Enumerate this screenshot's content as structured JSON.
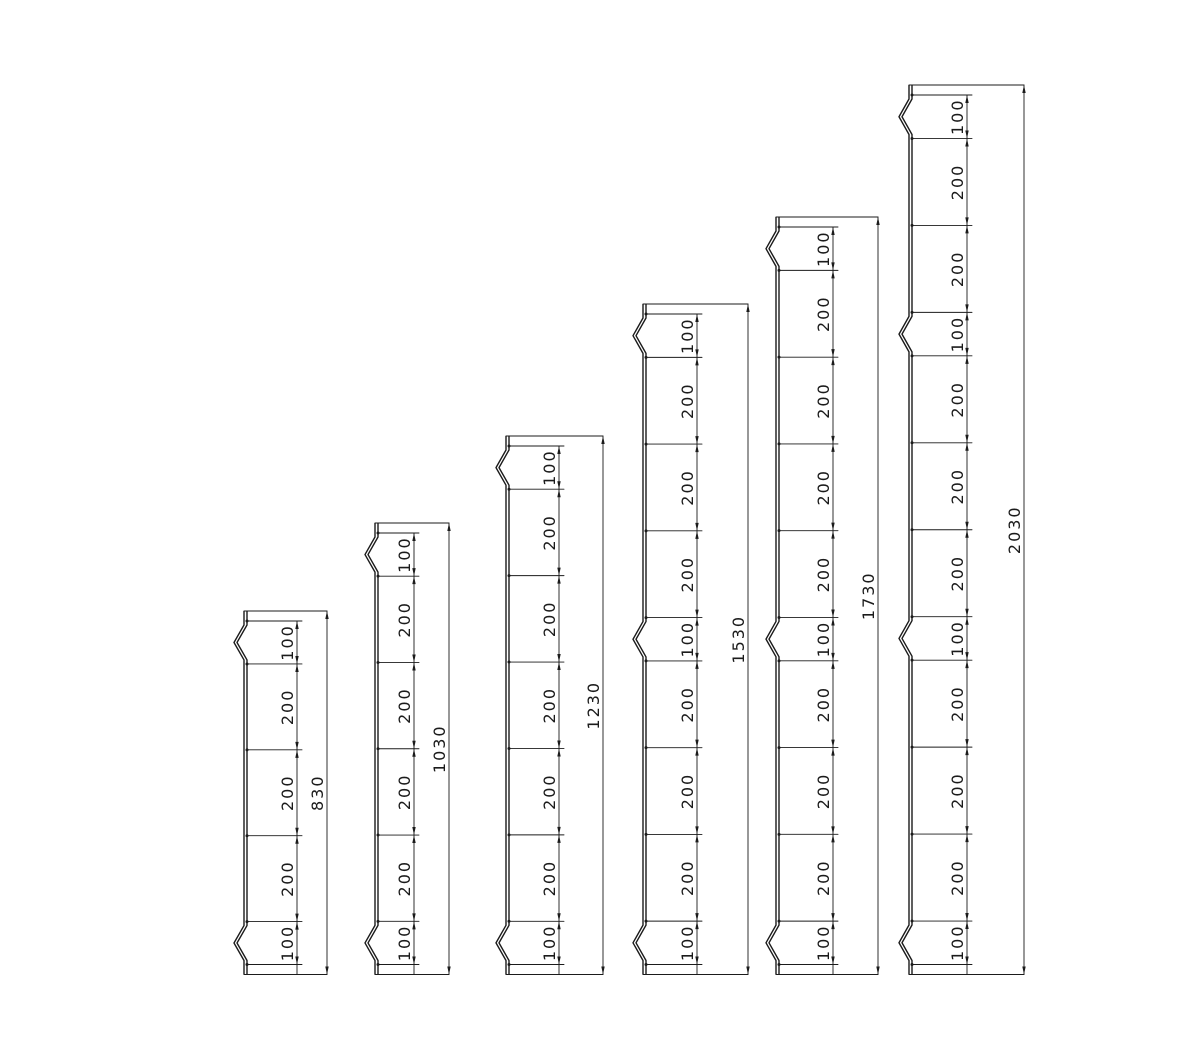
{
  "page": {
    "width": 1201,
    "height": 1048,
    "background": "#ffffff"
  },
  "drawing": {
    "stroke_color": "#1b1b1b",
    "baseline_y": 974.5,
    "end_margin_px": 10,
    "bump_depth_px": 10,
    "bump_inset_px": 4,
    "sheet_gap_px": 3,
    "label_font_px": 16,
    "label_letter_spacing_px": 2,
    "profiles": [
      {
        "name": "profile-830",
        "total_label": "830",
        "total": 830,
        "segments": [
          100,
          200,
          200,
          200,
          100
        ],
        "segment_labels": [
          "100",
          "200",
          "200",
          "200",
          "100"
        ],
        "bump_segments": [
          0,
          4
        ],
        "x_edge": 247,
        "x_dim_chain": 297,
        "x_dim_total": 327,
        "top_y": 611
      },
      {
        "name": "profile-1030",
        "total_label": "1030",
        "total": 1030,
        "segments": [
          100,
          200,
          200,
          200,
          200,
          100
        ],
        "segment_labels": [
          "100",
          "200",
          "200",
          "200",
          "200",
          "100"
        ],
        "bump_segments": [
          0,
          5
        ],
        "x_edge": 378,
        "x_dim_chain": 414,
        "x_dim_total": 449,
        "top_y": 523
      },
      {
        "name": "profile-1230",
        "total_label": "1230",
        "total": 1230,
        "segments": [
          100,
          200,
          200,
          200,
          200,
          200,
          100
        ],
        "segment_labels": [
          "100",
          "200",
          "200",
          "200",
          "200",
          "200",
          "100"
        ],
        "bump_segments": [
          0,
          6
        ],
        "x_edge": 509,
        "x_dim_chain": 559,
        "x_dim_total": 603,
        "top_y": 436
      },
      {
        "name": "profile-1530",
        "total_label": "1530",
        "total": 1530,
        "segments": [
          100,
          200,
          200,
          200,
          100,
          200,
          200,
          200,
          100
        ],
        "segment_labels": [
          "100",
          "200",
          "200",
          "200",
          "100",
          "200",
          "200",
          "200",
          "100"
        ],
        "bump_segments": [
          0,
          4,
          8
        ],
        "x_edge": 646,
        "x_dim_chain": 697,
        "x_dim_total": 748,
        "top_y": 304
      },
      {
        "name": "profile-1730",
        "total_label": "1730",
        "total": 1730,
        "segments": [
          100,
          200,
          200,
          200,
          200,
          100,
          200,
          200,
          200,
          100
        ],
        "segment_labels": [
          "100",
          "200",
          "200",
          "200",
          "200",
          "100",
          "200",
          "200",
          "200",
          "100"
        ],
        "bump_segments": [
          0,
          5,
          9
        ],
        "x_edge": 779,
        "x_dim_chain": 833,
        "x_dim_total": 878,
        "top_y": 217
      },
      {
        "name": "profile-2030",
        "total_label": "2030",
        "total": 2030,
        "segments": [
          100,
          200,
          200,
          100,
          200,
          200,
          200,
          100,
          200,
          200,
          200,
          100
        ],
        "segment_labels": [
          "100",
          "200",
          "200",
          "100",
          "200",
          "200",
          "200",
          "100",
          "200",
          "200",
          "200",
          "100"
        ],
        "bump_segments": [
          0,
          3,
          7,
          11
        ],
        "x_edge": 912,
        "x_dim_chain": 967,
        "x_dim_total": 1024,
        "top_y": 85
      }
    ]
  }
}
